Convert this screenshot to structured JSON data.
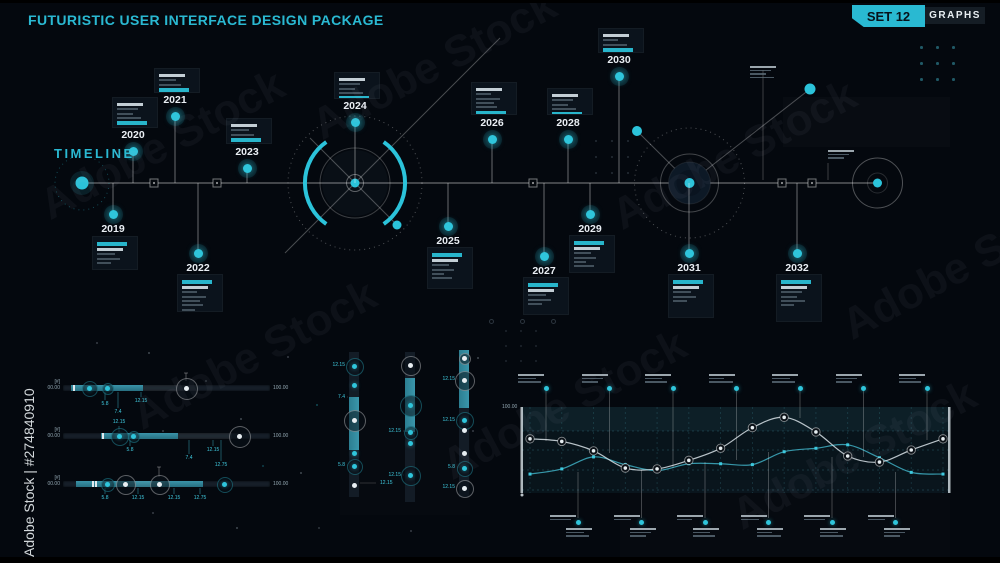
{
  "header": {
    "title": "FUTURISTIC USER INTERFACE DESIGN PACKAGE",
    "set_badge": "SET 12",
    "category_badge": "GRAPHS"
  },
  "watermark": {
    "diagonal_text": "Adobe Stock",
    "side_text": "Adobe Stock | #274840910"
  },
  "timeline": {
    "label": "TIMELINE",
    "years": [
      {
        "year": "2019"
      },
      {
        "year": "2020"
      },
      {
        "year": "2021"
      },
      {
        "year": "2022"
      },
      {
        "year": "2023"
      },
      {
        "year": "2024"
      },
      {
        "year": "2025"
      },
      {
        "year": "2026"
      },
      {
        "year": "2027"
      },
      {
        "year": "2028"
      },
      {
        "year": "2029"
      },
      {
        "year": "2030"
      },
      {
        "year": "2031"
      },
      {
        "year": "2032"
      }
    ]
  },
  "h_sliders": {
    "bars": [
      {
        "index_label": "[#]",
        "min_label": "00.00",
        "max_label": "100.00",
        "ticks": [
          {
            "label": "5.8"
          },
          {
            "label": "7.4"
          },
          {
            "label": "12.15"
          }
        ]
      },
      {
        "index_label": "[#]",
        "min_label": "00.00",
        "max_label": "100.00",
        "ticks": [
          {
            "label": "12.15"
          },
          {
            "label": "5.8"
          },
          {
            "label": "12.15"
          },
          {
            "label": "7.4"
          },
          {
            "label": "12.75"
          }
        ]
      },
      {
        "index_label": "[#]",
        "min_label": "00.00",
        "max_label": "100.00",
        "ticks": [
          {
            "label": "5.8"
          },
          {
            "label": "12.15"
          },
          {
            "label": "12.15"
          },
          {
            "label": "12.75"
          }
        ]
      }
    ]
  },
  "v_sliders": {
    "columns": [
      {
        "labels": [
          "12.15",
          "7.4",
          "5.8",
          "12.15"
        ]
      },
      {
        "labels": [
          "12.15",
          "12.15"
        ]
      },
      {
        "labels": [
          "12.15",
          "12.15",
          "5.8",
          "12.15"
        ]
      }
    ]
  },
  "chart_data": {
    "type": "line",
    "title": "",
    "y_max_label": "100.00",
    "ylim": [
      0,
      100
    ],
    "x_points": 14,
    "grid": "dashed-teal",
    "legend": "none",
    "series": [
      {
        "name": "white-line",
        "color": "#dde6ea",
        "marker": "ring-dot",
        "values": [
          63,
          60,
          49,
          29,
          28,
          38,
          52,
          76,
          88,
          71,
          43,
          36,
          50,
          63
        ]
      },
      {
        "name": "teal-line",
        "color": "#3ba8bd",
        "marker": "square",
        "values": [
          22,
          28,
          42,
          33,
          26,
          34,
          34,
          33,
          48,
          52,
          56,
          41,
          24,
          22
        ]
      }
    ]
  },
  "colors": {
    "background": "#04080e",
    "accent_cyan": "#2bc3da",
    "teal_fill": "#2e8296",
    "text_primary": "#e9eef3",
    "text_muted": "#7d8c98",
    "badge_text_dark": "#07121a",
    "panel_dark": "#0b131c"
  }
}
